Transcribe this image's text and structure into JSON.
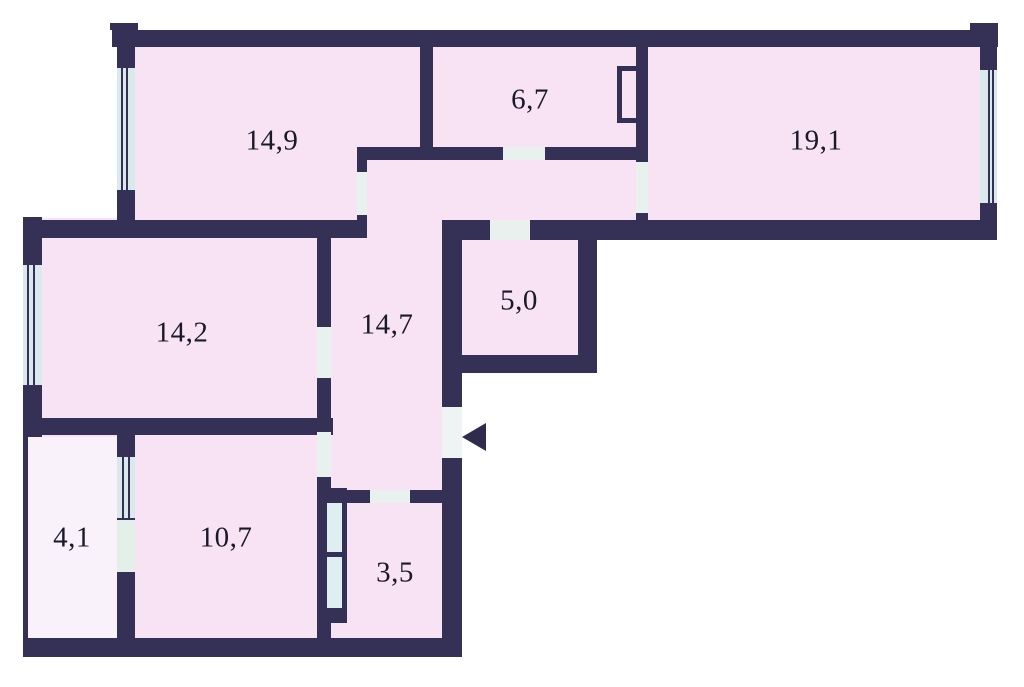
{
  "plan": {
    "canvas": {
      "width": 1024,
      "height": 687
    },
    "colors": {
      "wall": "#353056",
      "room": "#f8e3f5",
      "balcony": "#f9f2fa",
      "window": "#d9e9ec",
      "door": "#e8f1ee",
      "balcony_door": "#e4efe9",
      "entrance": "#eef3f3",
      "duct_cell": "#dfeef0",
      "label": "#191929",
      "outside": "#ffffff"
    },
    "fills": [
      {
        "name": "fill-top-band",
        "x": 117,
        "y": 30,
        "w": 880,
        "h": 210,
        "fill": "room"
      },
      {
        "name": "fill-left-block",
        "x": 23,
        "y": 218,
        "w": 439,
        "h": 439,
        "fill": "room"
      },
      {
        "name": "fill-pantry-block",
        "x": 442,
        "y": 222,
        "w": 155,
        "h": 151,
        "fill": "room"
      },
      {
        "name": "fill-balcony",
        "x": 28,
        "y": 437,
        "w": 89,
        "h": 201,
        "fill": "balcony"
      }
    ],
    "walls": [
      {
        "name": "wall-top",
        "x": 112,
        "y": 30,
        "w": 886,
        "h": 17
      },
      {
        "name": "wall-top-left-tab",
        "x": 110,
        "y": 23,
        "w": 28,
        "h": 7
      },
      {
        "name": "wall-top-right-tab",
        "x": 970,
        "y": 23,
        "w": 28,
        "h": 7
      },
      {
        "name": "wall-hall-top",
        "x": 357,
        "y": 147,
        "w": 291,
        "h": 13
      },
      {
        "name": "wall-room149-bottom",
        "x": 23,
        "y": 220,
        "w": 344,
        "h": 18
      },
      {
        "name": "wall-topband-bottom",
        "x": 442,
        "y": 220,
        "w": 555,
        "h": 20
      },
      {
        "name": "wall-pantry-bottom",
        "x": 442,
        "y": 355,
        "w": 155,
        "h": 18
      },
      {
        "name": "wall-room142-bottom",
        "x": 23,
        "y": 418,
        "w": 310,
        "h": 17
      },
      {
        "name": "wall-bath-top",
        "x": 317,
        "y": 490,
        "w": 126,
        "h": 13
      },
      {
        "name": "wall-plan-bottom",
        "x": 23,
        "y": 638,
        "w": 439,
        "h": 19
      },
      {
        "name": "wall-left-upper",
        "x": 117,
        "y": 30,
        "w": 18,
        "h": 208
      },
      {
        "name": "wall-149-67",
        "x": 420,
        "y": 30,
        "w": 13,
        "h": 130
      },
      {
        "name": "wall-67-191",
        "x": 636,
        "y": 30,
        "w": 12,
        "h": 132
      },
      {
        "name": "wall-67-191-stub",
        "x": 636,
        "y": 213,
        "w": 12,
        "h": 9
      },
      {
        "name": "wall-right",
        "x": 980,
        "y": 30,
        "w": 17,
        "h": 210
      },
      {
        "name": "wall-149-door-jamb",
        "x": 357,
        "y": 160,
        "w": 10,
        "h": 62
      },
      {
        "name": "wall-142-left",
        "x": 23,
        "y": 217,
        "w": 19,
        "h": 220
      },
      {
        "name": "wall-corridor-left",
        "x": 317,
        "y": 237,
        "w": 14,
        "h": 401
      },
      {
        "name": "wall-corridor-right",
        "x": 442,
        "y": 222,
        "w": 20,
        "h": 435
      },
      {
        "name": "wall-pantry-right",
        "x": 578,
        "y": 222,
        "w": 19,
        "h": 151
      },
      {
        "name": "wall-balcony-left",
        "x": 23,
        "y": 437,
        "w": 5,
        "h": 220
      },
      {
        "name": "wall-balcony-room107",
        "x": 117,
        "y": 435,
        "w": 18,
        "h": 203
      },
      {
        "name": "wall-bath-shaft-block",
        "x": 317,
        "y": 488,
        "w": 30,
        "h": 135
      }
    ],
    "windows": [
      {
        "name": "window-room149",
        "x": 117,
        "y": 68,
        "w": 18,
        "h": 122,
        "lines": [
          0.22,
          0.5
        ]
      },
      {
        "name": "window-room191",
        "x": 980,
        "y": 70,
        "w": 17,
        "h": 133,
        "lines": [
          0.45,
          0.72
        ]
      },
      {
        "name": "window-room142",
        "x": 23,
        "y": 265,
        "w": 19,
        "h": 120,
        "lines": [
          0.22,
          0.5
        ]
      },
      {
        "name": "window-balcony",
        "x": 117,
        "y": 457,
        "w": 18,
        "h": 61,
        "lines": [
          0.3,
          0.6
        ]
      }
    ],
    "doors": [
      {
        "name": "door-room67",
        "x": 503,
        "y": 147,
        "w": 42,
        "h": 13,
        "fill": "door"
      },
      {
        "name": "door-pantry",
        "x": 490,
        "y": 220,
        "w": 40,
        "h": 20,
        "fill": "door"
      },
      {
        "name": "door-room191",
        "x": 636,
        "y": 162,
        "w": 12,
        "h": 51,
        "fill": "door"
      },
      {
        "name": "door-room149",
        "x": 357,
        "y": 172,
        "w": 10,
        "h": 43,
        "fill": "door"
      },
      {
        "name": "door-room142",
        "x": 317,
        "y": 327,
        "w": 14,
        "h": 51,
        "fill": "door"
      },
      {
        "name": "door-room107",
        "x": 317,
        "y": 432,
        "w": 14,
        "h": 45,
        "fill": "door"
      },
      {
        "name": "door-bath",
        "x": 370,
        "y": 490,
        "w": 40,
        "h": 13,
        "fill": "door"
      },
      {
        "name": "door-balcony",
        "x": 117,
        "y": 520,
        "w": 18,
        "h": 52,
        "fill": "balcony_door"
      },
      {
        "name": "shaft-cell-upper",
        "x": 327,
        "y": 503,
        "w": 15,
        "h": 49,
        "fill": "duct_cell"
      },
      {
        "name": "shaft-cell-lower",
        "x": 327,
        "y": 557,
        "w": 15,
        "h": 51,
        "fill": "duct_cell"
      }
    ],
    "kitchen_duct": {
      "name": "duct-room67",
      "x": 617,
      "y": 66,
      "w": 24,
      "h": 57
    },
    "entrance": {
      "opening": {
        "name": "entrance-opening",
        "x": 442,
        "y": 407,
        "w": 20,
        "h": 51,
        "fill": "entrance"
      },
      "arrow": {
        "name": "entrance-arrow-icon",
        "x": 462,
        "y": 423
      }
    },
    "rooms": [
      {
        "name": "room-label-14-9",
        "label": "14,9",
        "cx": 272,
        "cy": 141
      },
      {
        "name": "room-label-6-7",
        "label": "6,7",
        "cx": 530,
        "cy": 100
      },
      {
        "name": "room-label-19-1",
        "label": "19,1",
        "cx": 816,
        "cy": 141
      },
      {
        "name": "room-label-14-2",
        "label": "14,2",
        "cx": 182,
        "cy": 333
      },
      {
        "name": "room-label-14-7",
        "label": "14,7",
        "cx": 387,
        "cy": 325
      },
      {
        "name": "room-label-5-0",
        "label": "5,0",
        "cx": 519,
        "cy": 301
      },
      {
        "name": "room-label-4-1",
        "label": "4,1",
        "cx": 72,
        "cy": 538
      },
      {
        "name": "room-label-10-7",
        "label": "10,7",
        "cx": 226,
        "cy": 538
      },
      {
        "name": "room-label-3-5",
        "label": "3,5",
        "cx": 395,
        "cy": 573
      }
    ]
  }
}
